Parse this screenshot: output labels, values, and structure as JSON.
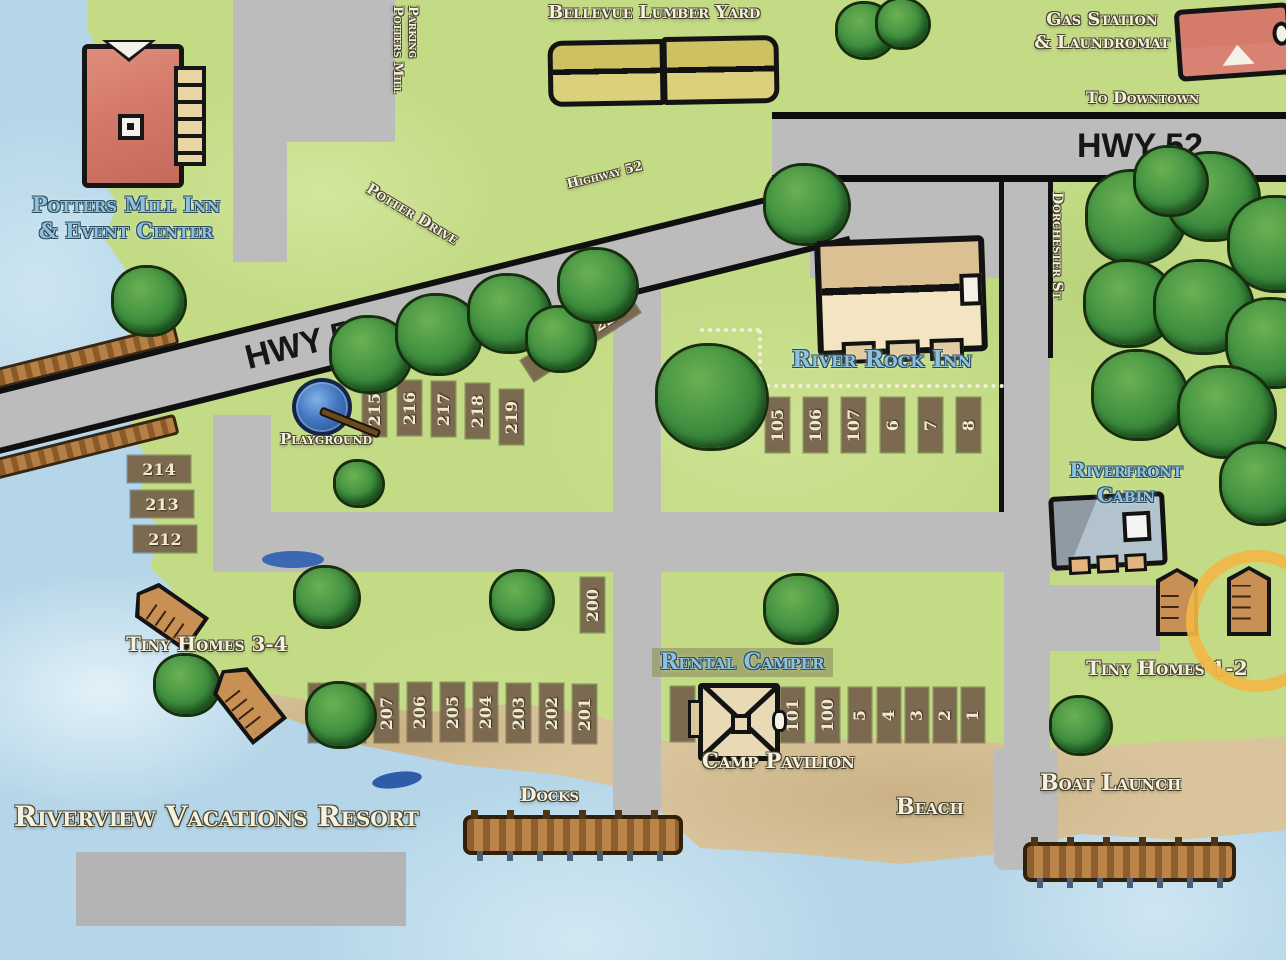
{
  "map": {
    "title": "Riverview Vacations Resort",
    "roads": {
      "hwy52": "HWY 52",
      "highway52_script": "Highway 52",
      "potter_drive": "Potter Drive",
      "dorchester_st": "Dorchester St",
      "to_downtown": "To Downtown",
      "potters_mill_parking_line1": "Potters Mill",
      "potters_mill_parking_line2": "Parking"
    },
    "places": {
      "potters_mill_inn_line1": "Potters Mill Inn",
      "potters_mill_inn_line2": "& Event Center",
      "bellevue_lumber_yard": "Bellevue Lumber Yard",
      "gas_station_line1": "Gas Station",
      "gas_station_line2": "& Laundromat",
      "river_rock_inn": "River Rock Inn",
      "riverfront_cabin_line1": "Riverfront",
      "riverfront_cabin_line2": "Cabin",
      "rental_camper": "Rental Camper",
      "camp_pavilion": "Camp Pavilion",
      "playground": "Playground",
      "tiny_homes_34": "Tiny Homes 3-4",
      "tiny_homes_12": "Tiny Homes 1-2",
      "docks": "Docks",
      "beach": "Beach",
      "boat_launch": "Boat Launch"
    },
    "sites": {
      "s1": "1",
      "s2": "2",
      "s3": "3",
      "s4": "4",
      "s5": "5",
      "s6": "6",
      "s7": "7",
      "s8": "8",
      "s100": "100",
      "s101": "101",
      "s105": "105",
      "s106": "106",
      "s107": "107",
      "s200": "200",
      "s201": "201",
      "s202": "202",
      "s203": "203",
      "s204": "204",
      "s205": "205",
      "s206": "206",
      "s207": "207",
      "s208": "208",
      "s209": "209",
      "s212": "212",
      "s213": "213",
      "s214": "214",
      "s215": "215",
      "s216": "216",
      "s217": "217",
      "s218": "218",
      "s219": "219",
      "s220": "220",
      "s221": "221"
    },
    "colors": {
      "water": "#b5d6e8",
      "grass": "#c3db85",
      "road": "#bcbcbc",
      "sand": "#d9c49c",
      "site_brown": "#7b6950",
      "tree_green": "#3f8f3f",
      "building_red": "#d98173",
      "building_tan": "#f4e5c2",
      "lumber_yellow": "#d3c673",
      "cabin_gray": "#aebfca",
      "dock_brown": "#bb8448",
      "label_cream": "#f6f1df",
      "label_blue": "#8ec1de",
      "highlight_circle": "#f1b747"
    }
  }
}
